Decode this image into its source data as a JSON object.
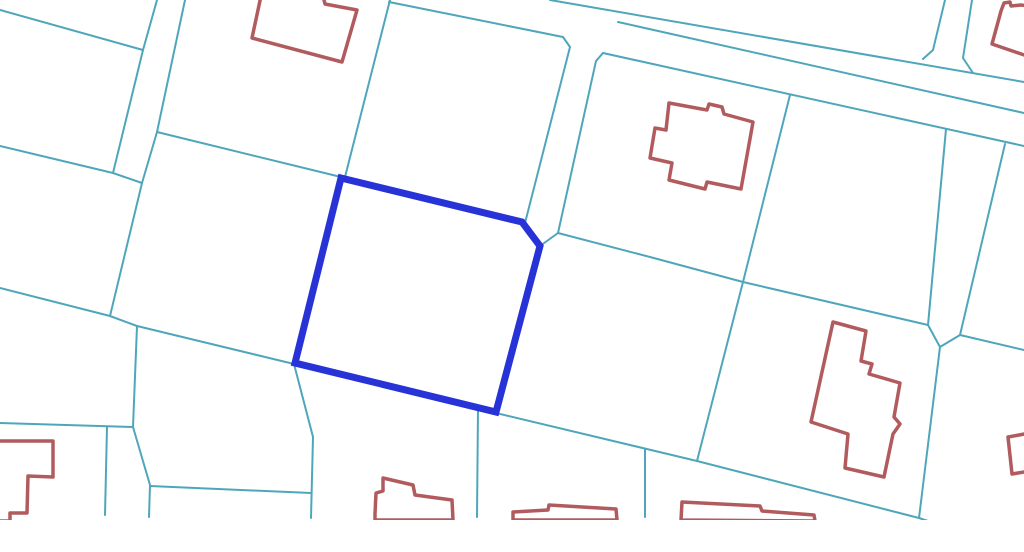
{
  "canvas": {
    "width": 1024,
    "height": 552,
    "background": "#ffffff"
  },
  "map": {
    "type": "cadastral-parcel-map",
    "colors": {
      "parcel_line": "#4fa6bb",
      "building_outline": "#b25b5e",
      "highlight_stroke": "#2733d6",
      "background": "#ffffff",
      "bottom_margin": "#ffffff"
    },
    "stroke_widths": {
      "parcel_line": 2,
      "building_outline": 3.5,
      "highlight": 7
    },
    "content_cut_y": 520,
    "highlight_parcel": {
      "points": [
        [
          341,
          178
        ],
        [
          522,
          222
        ],
        [
          540,
          246
        ],
        [
          496,
          412
        ],
        [
          295,
          363
        ]
      ]
    },
    "parcel_lines": [
      {
        "points": [
          [
            0,
            10
          ],
          [
            143,
            50
          ]
        ]
      },
      {
        "points": [
          [
            157,
            0
          ],
          [
            143,
            50
          ],
          [
            113,
            173
          ]
        ]
      },
      {
        "points": [
          [
            0,
            146
          ],
          [
            113,
            173
          ],
          [
            142,
            183
          ]
        ]
      },
      {
        "points": [
          [
            185,
            0
          ],
          [
            157,
            132
          ],
          [
            142,
            183
          ],
          [
            110,
            316
          ]
        ]
      },
      {
        "points": [
          [
            157,
            132
          ],
          [
            341,
            177
          ]
        ]
      },
      {
        "points": [
          [
            390,
            0
          ],
          [
            345,
            177
          ]
        ]
      },
      {
        "points": [
          [
            0,
            288
          ],
          [
            110,
            316
          ],
          [
            137,
            326
          ],
          [
            294,
            364
          ]
        ]
      },
      {
        "points": [
          [
            294,
            364
          ],
          [
            496,
            413
          ],
          [
            697,
            461
          ],
          [
            919,
            518
          ],
          [
            928,
            521
          ]
        ]
      },
      {
        "points": [
          [
            137,
            326
          ],
          [
            133,
            427
          ],
          [
            150,
            485
          ],
          [
            149,
            517
          ]
        ]
      },
      {
        "points": [
          [
            0,
            423
          ],
          [
            133,
            427
          ]
        ]
      },
      {
        "points": [
          [
            107,
            427
          ],
          [
            105,
            515
          ]
        ]
      },
      {
        "points": [
          [
            150,
            486
          ],
          [
            311,
            493
          ]
        ]
      },
      {
        "points": [
          [
            294,
            364
          ],
          [
            313,
            437
          ],
          [
            311,
            518
          ]
        ]
      },
      {
        "points": [
          [
            478,
            409
          ],
          [
            477,
            517
          ]
        ]
      },
      {
        "points": [
          [
            645,
            449
          ],
          [
            645,
            517
          ]
        ]
      },
      {
        "points": [
          [
            550,
            0
          ],
          [
            1024,
            82
          ]
        ]
      },
      {
        "points": [
          [
            389,
            2
          ],
          [
            563,
            37
          ]
        ]
      },
      {
        "points": [
          [
            603,
            53
          ],
          [
            1024,
            146
          ]
        ]
      },
      {
        "points": [
          [
            618,
            22
          ],
          [
            1024,
            113
          ]
        ]
      },
      {
        "points": [
          [
            563,
            37
          ],
          [
            570,
            47
          ],
          [
            525,
            223
          ]
        ]
      },
      {
        "points": [
          [
            603,
            53
          ],
          [
            596,
            61
          ],
          [
            558,
            233
          ],
          [
            540,
            246
          ]
        ]
      },
      {
        "points": [
          [
            558,
            233
          ],
          [
            650,
            257
          ],
          [
            743,
            282
          ],
          [
            928,
            325
          ]
        ]
      },
      {
        "points": [
          [
            790,
            95
          ],
          [
            743,
            282
          ],
          [
            697,
            461
          ]
        ]
      },
      {
        "points": [
          [
            945,
            0
          ],
          [
            933,
            50
          ],
          [
            923,
            59
          ]
        ]
      },
      {
        "points": [
          [
            972,
            0
          ],
          [
            963,
            58
          ],
          [
            973,
            73
          ]
        ]
      },
      {
        "points": [
          [
            946,
            129
          ],
          [
            928,
            325
          ]
        ]
      },
      {
        "points": [
          [
            1005,
            144
          ],
          [
            960,
            335
          ]
        ]
      },
      {
        "points": [
          [
            928,
            325
          ],
          [
            940,
            347
          ],
          [
            919,
            518
          ]
        ]
      },
      {
        "points": [
          [
            960,
            335
          ],
          [
            940,
            347
          ]
        ]
      },
      {
        "points": [
          [
            960,
            335
          ],
          [
            1024,
            350
          ]
        ]
      }
    ],
    "buildings": [
      {
        "points": [
          [
            261,
            -4
          ],
          [
            252,
            38
          ],
          [
            342,
            62
          ],
          [
            357,
            10
          ],
          [
            325,
            4
          ],
          [
            323,
            -4
          ]
        ]
      },
      {
        "points": [
          [
            669,
            103
          ],
          [
            707,
            110
          ],
          [
            709,
            104
          ],
          [
            722,
            107
          ],
          [
            724,
            114
          ],
          [
            753,
            122
          ],
          [
            741,
            189
          ],
          [
            707,
            182
          ],
          [
            705,
            189
          ],
          [
            669,
            180
          ],
          [
            672,
            163
          ],
          [
            650,
            158
          ],
          [
            655,
            128
          ],
          [
            666,
            130
          ]
        ]
      },
      {
        "points": [
          [
            833,
            322
          ],
          [
            866,
            331
          ],
          [
            861,
            361
          ],
          [
            872,
            364
          ],
          [
            869,
            374
          ],
          [
            900,
            383
          ],
          [
            894,
            417
          ],
          [
            900,
            424
          ],
          [
            893,
            434
          ],
          [
            889,
            453
          ],
          [
            884,
            477
          ],
          [
            845,
            468
          ],
          [
            848,
            434
          ],
          [
            811,
            422
          ]
        ]
      },
      {
        "points": [
          [
            1001,
            11
          ],
          [
            1004,
            3
          ],
          [
            1010,
            2
          ],
          [
            1011,
            6
          ],
          [
            1021,
            5
          ],
          [
            1030,
            6
          ],
          [
            1030,
            57
          ],
          [
            992,
            44
          ]
        ]
      },
      {
        "points": [
          [
            375,
            514
          ],
          [
            376,
            493
          ],
          [
            383,
            491
          ],
          [
            383,
            478
          ],
          [
            413,
            485
          ],
          [
            415,
            495
          ],
          [
            452,
            500
          ],
          [
            453,
            520
          ],
          [
            375,
            520
          ]
        ]
      },
      {
        "points": [
          [
            513,
            520
          ],
          [
            513,
            512
          ],
          [
            548,
            510
          ],
          [
            549,
            505
          ],
          [
            616,
            509
          ],
          [
            617,
            520
          ]
        ]
      },
      {
        "points": [
          [
            681,
            520
          ],
          [
            682,
            502
          ],
          [
            760,
            506
          ],
          [
            762,
            511
          ],
          [
            814,
            515
          ],
          [
            815,
            521
          ]
        ]
      },
      {
        "points": [
          [
            1030,
            433
          ],
          [
            1008,
            437
          ],
          [
            1012,
            474
          ],
          [
            1030,
            471
          ]
        ]
      },
      {
        "points": [
          [
            -5,
            441
          ],
          [
            53,
            441
          ],
          [
            53,
            477
          ],
          [
            28,
            476
          ],
          [
            27,
            513
          ],
          [
            10,
            513
          ],
          [
            10,
            521
          ],
          [
            -5,
            521
          ]
        ]
      }
    ]
  }
}
